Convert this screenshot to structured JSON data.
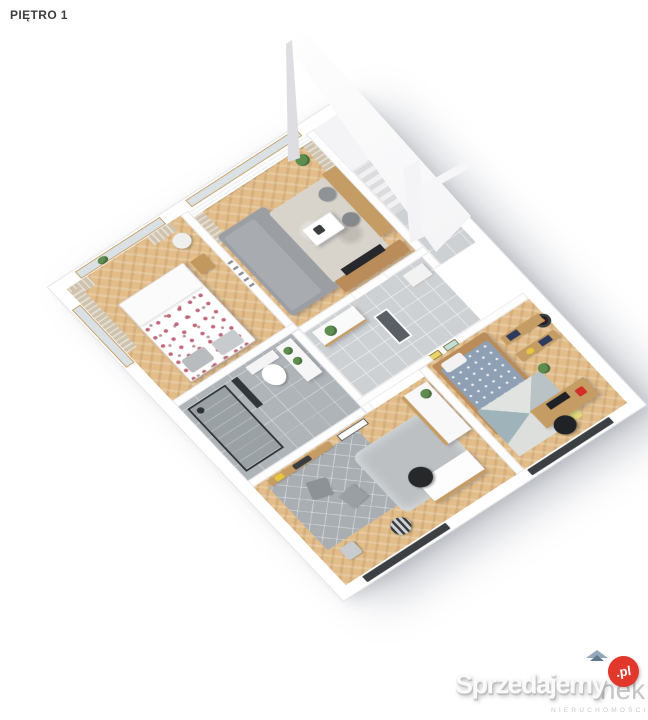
{
  "header": {
    "title": "PIĘTRO 1"
  },
  "floorplan": {
    "type": "isometric-3d-floor-plan-render",
    "colors": {
      "walls": "#ffffff",
      "wood_floor": "#e2bd8a",
      "bathroom_tile": "#aeb4b8",
      "hall_tile": "#ced1d3",
      "sofa": "#9b9ea2",
      "bed_floral_accent": "#b64d62",
      "kids_duvet": "#8fa0b4",
      "exterior_window_slot": "#3c4043"
    },
    "rooms": [
      {
        "id": "bedroom"
      },
      {
        "id": "living-room"
      },
      {
        "id": "staircase"
      },
      {
        "id": "bathroom"
      },
      {
        "id": "hallway"
      },
      {
        "id": "study-room"
      },
      {
        "id": "kids-room"
      }
    ]
  },
  "watermarks": {
    "primary": {
      "text": "Sprzedajemy",
      "suffix": ".pl",
      "badge_color": "#e2382c"
    },
    "secondary": {
      "visible_fragment": "nek",
      "subtitle": "NIERUCHOMOŚCI"
    }
  }
}
